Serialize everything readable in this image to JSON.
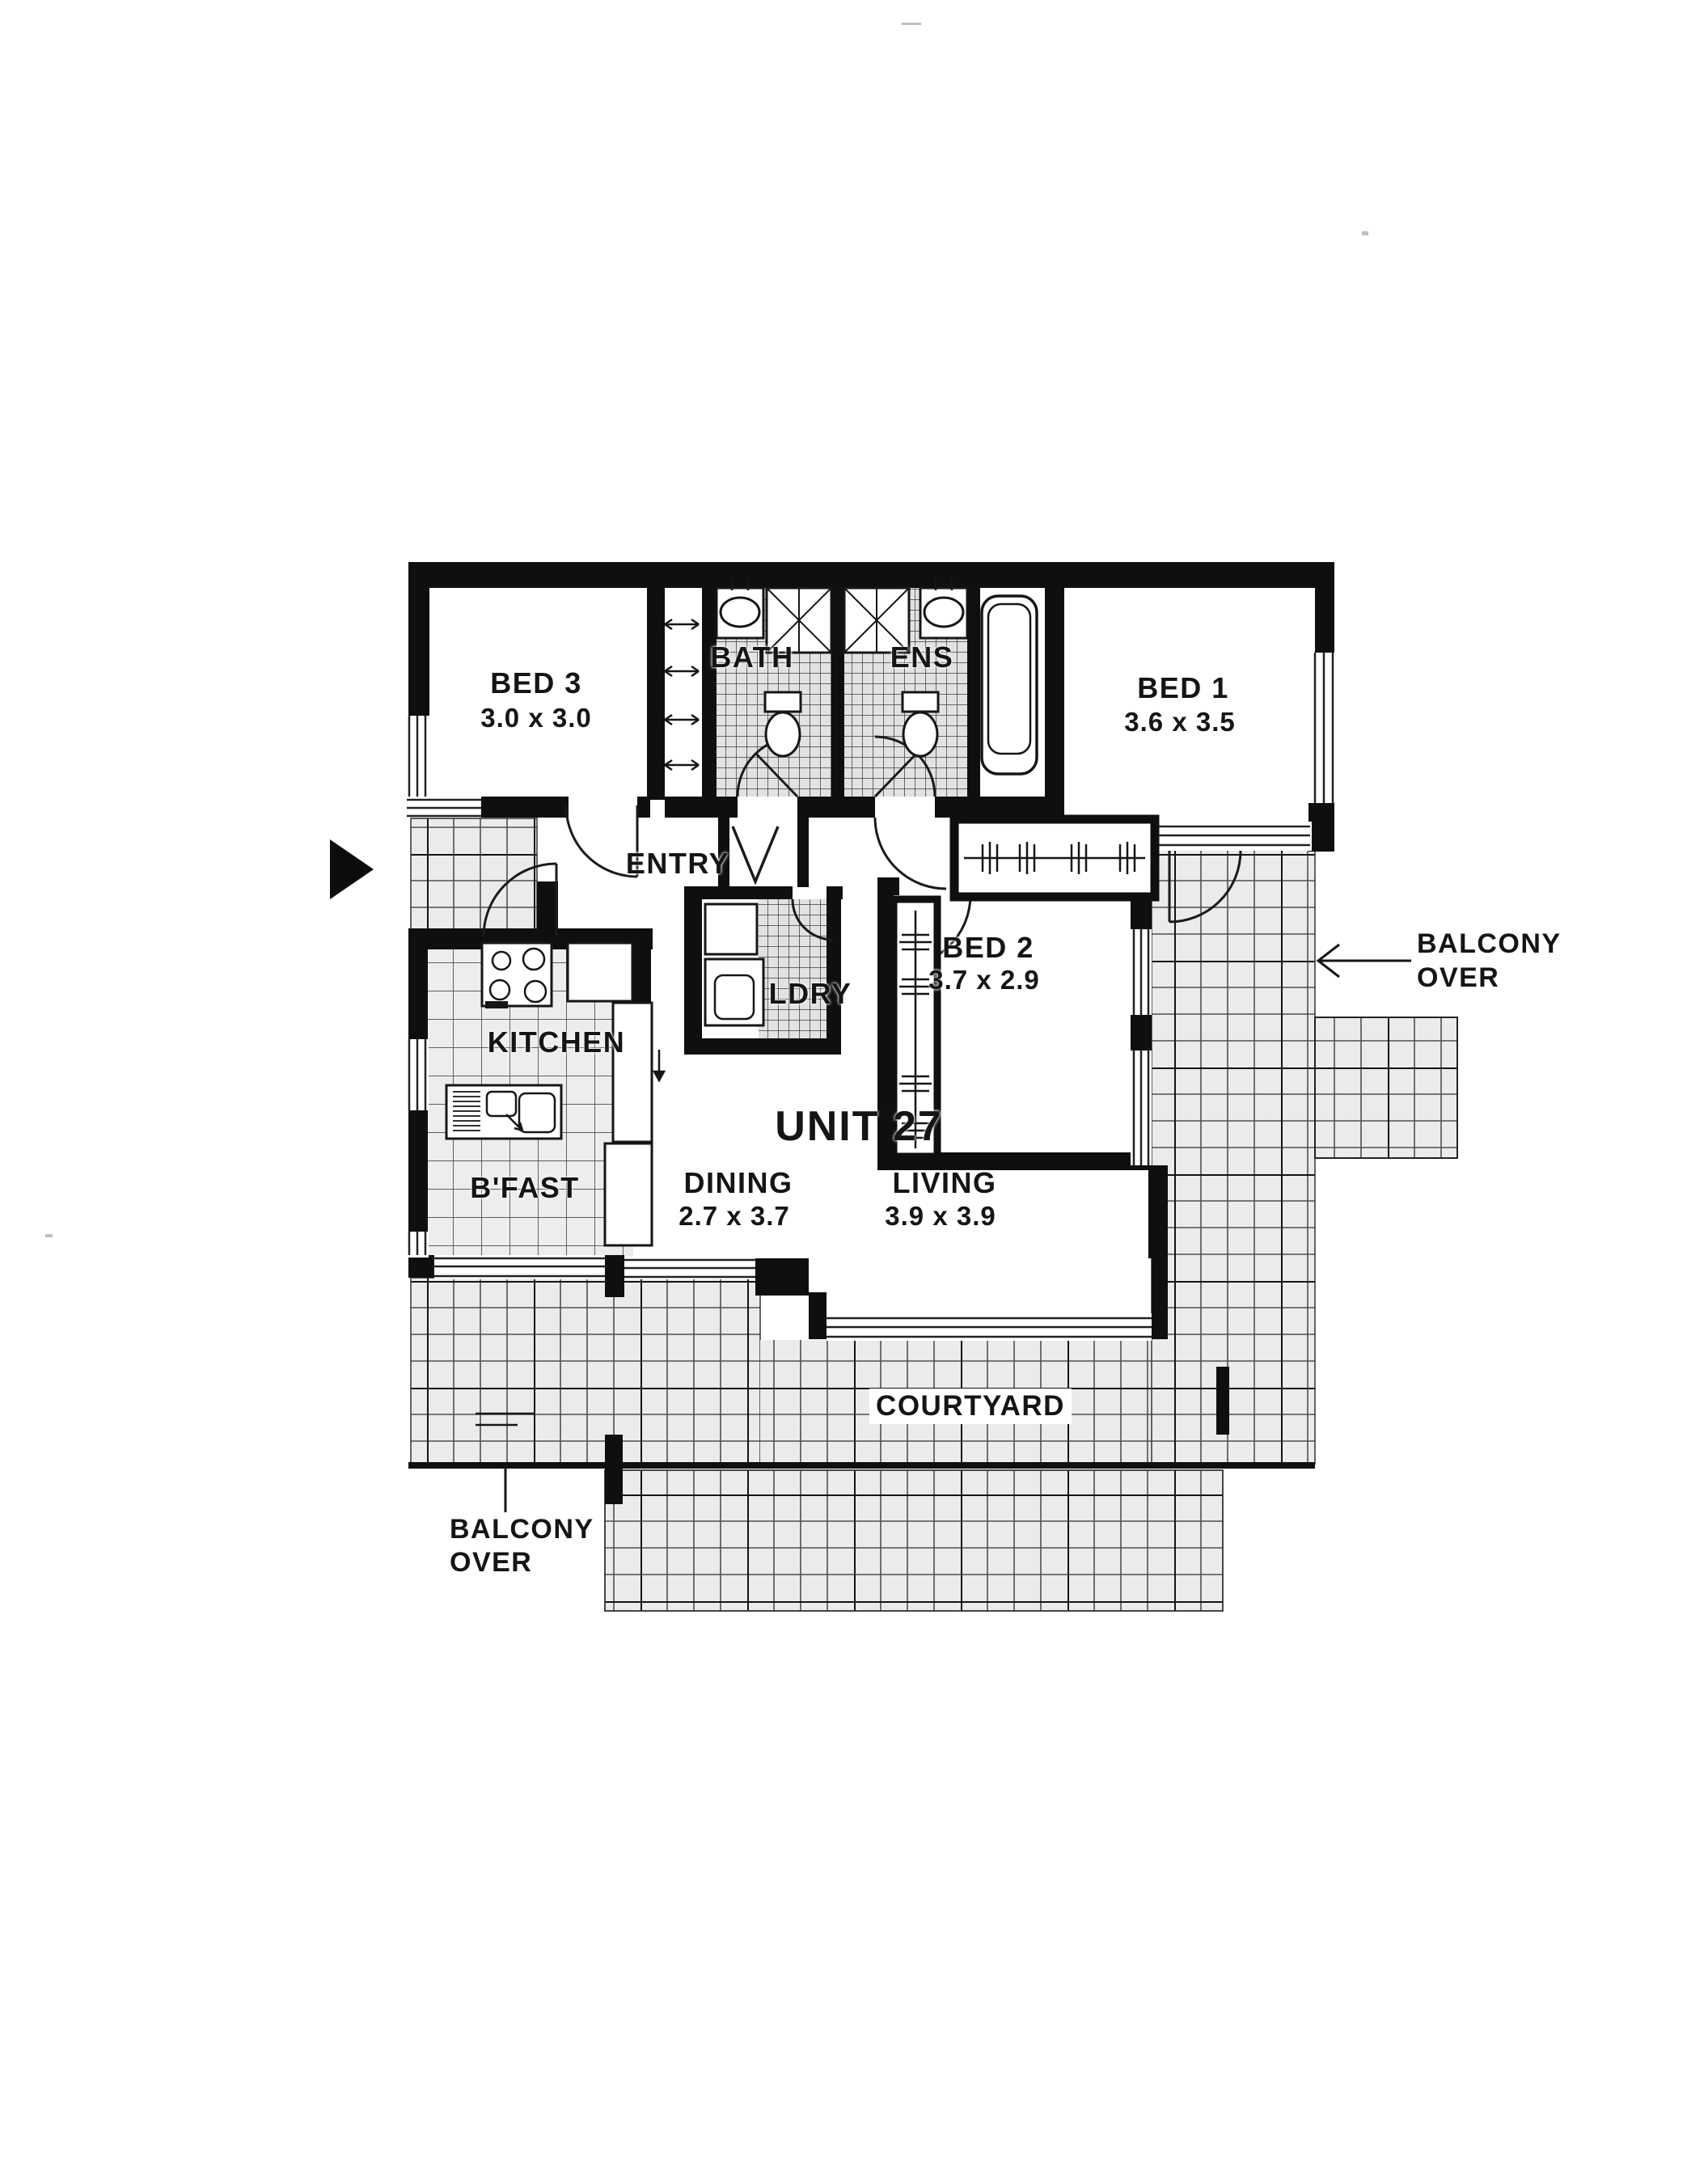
{
  "document": {
    "type": "floor-plan",
    "unit_title": "UNIT 27"
  },
  "rooms": {
    "bed3": {
      "name": "BED 3",
      "dims": "3.0 x 3.0"
    },
    "bath": {
      "name": "BATH"
    },
    "ens": {
      "name": "ENS"
    },
    "bed1": {
      "name": "BED 1",
      "dims": "3.6 x 3.5"
    },
    "entry": {
      "name": "ENTRY"
    },
    "bed2": {
      "name": "BED 2",
      "dims": "3.7 x 2.9"
    },
    "ldry": {
      "name": "LDRY"
    },
    "kitchen": {
      "name": "KITCHEN"
    },
    "bfast": {
      "name": "B'FAST"
    },
    "dining": {
      "name": "DINING",
      "dims": "2.7 x 3.7"
    },
    "living": {
      "name": "LIVING",
      "dims": "3.9 x 3.9"
    },
    "courtyard": {
      "name": "COURTYARD"
    }
  },
  "annotations": {
    "balcony_right": {
      "line1": "BALCONY",
      "line2": "OVER"
    },
    "balcony_bottom": {
      "line1": "BALCONY",
      "line2": "OVER"
    }
  },
  "colors": {
    "ink": "#151515",
    "paper": "#ffffff",
    "tile_bg": "#ebebeb",
    "tile_line": "#4f4f4f"
  }
}
